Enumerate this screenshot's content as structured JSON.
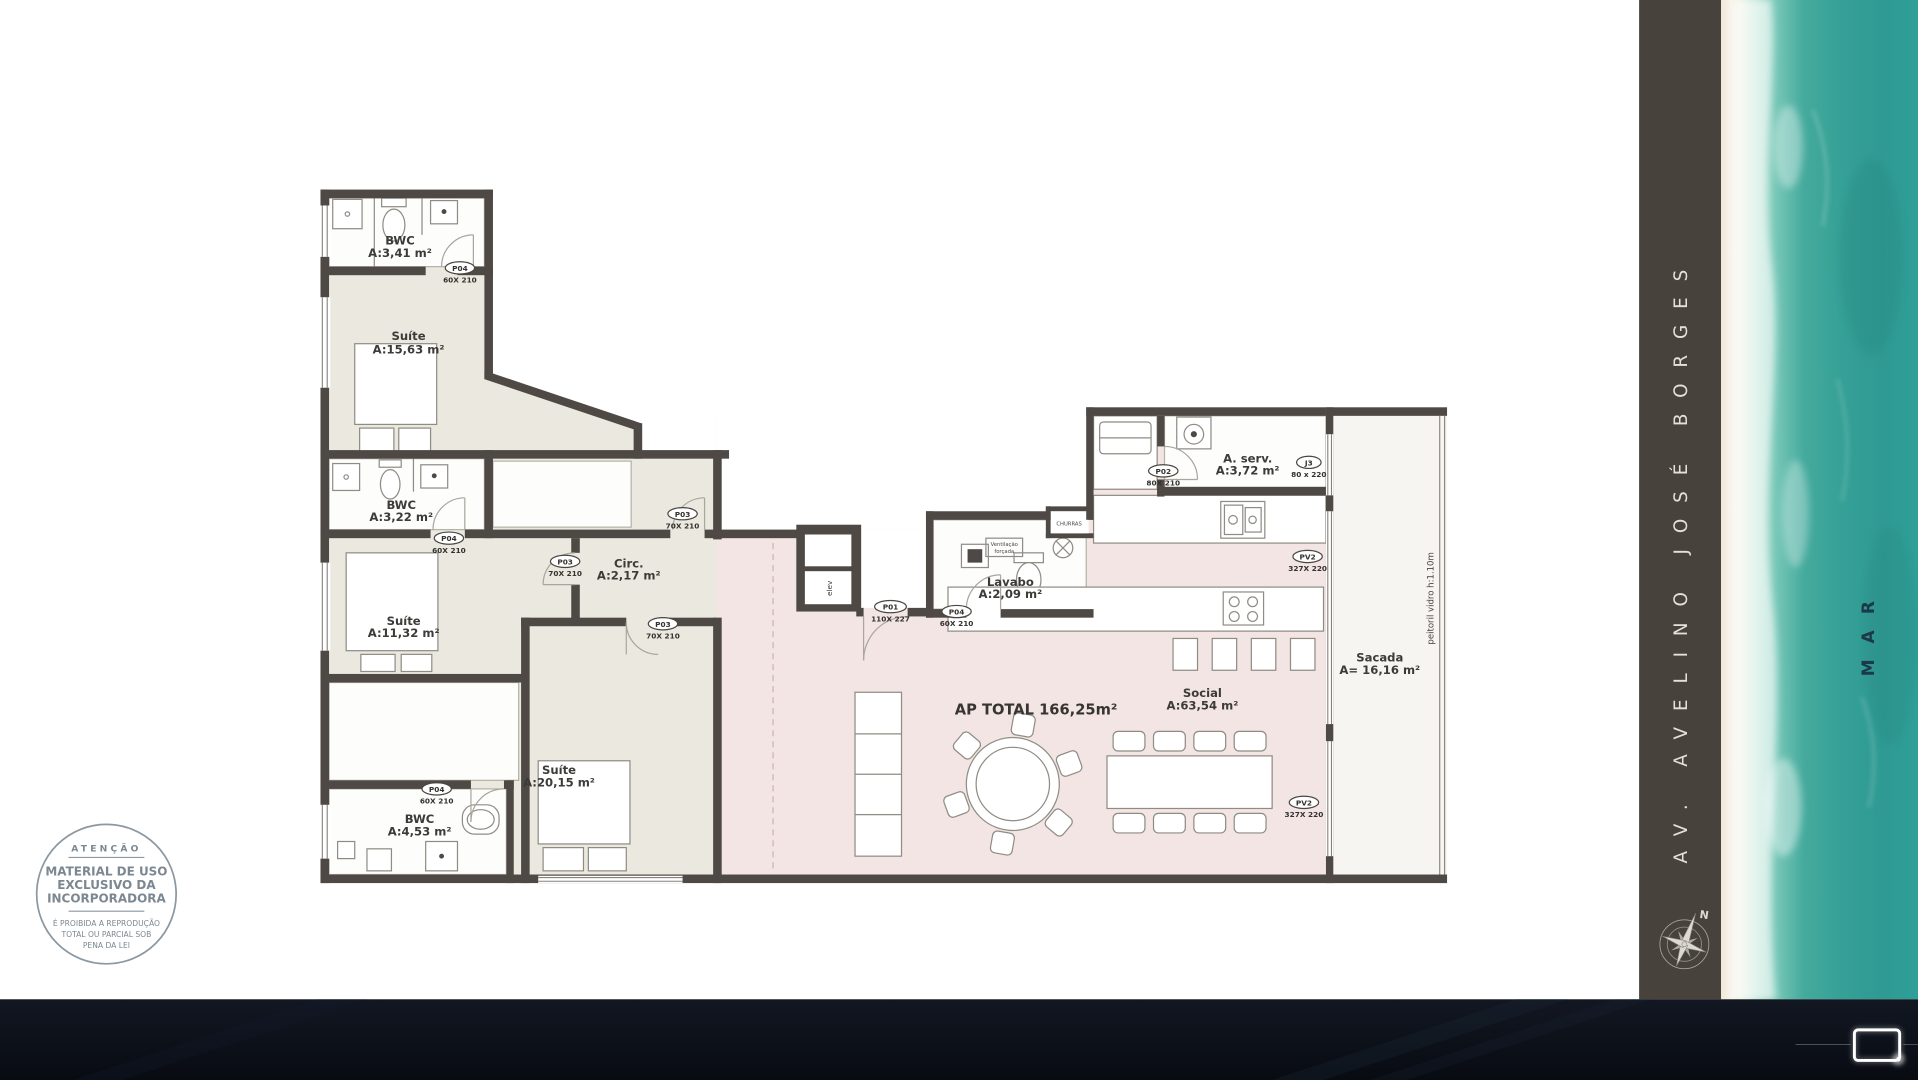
{
  "plan": {
    "rooms": [
      {
        "name": "BWC",
        "area": "A:3,41 m²"
      },
      {
        "name": "Suíte",
        "area": "A:15,63 m²"
      },
      {
        "name": "BWC",
        "area": "A:3,22 m²"
      },
      {
        "name": "Circ.",
        "area": "A:2,17 m²"
      },
      {
        "name": "Suíte",
        "area": "A:11,32 m²"
      },
      {
        "name": "Suíte",
        "area": "A:20,15 m²"
      },
      {
        "name": "BWC",
        "area": "A:4,53 m²"
      },
      {
        "name": "Lavabo",
        "area": "A:2,09 m²"
      },
      {
        "name": "A. serv.",
        "area": "A:3,72 m²"
      },
      {
        "name": "Social",
        "area": "A:63,54 m²"
      },
      {
        "name": "Sacada",
        "area": "A= 16,16 m²"
      }
    ],
    "doors": [
      {
        "code": "P04",
        "size": "60X 210"
      },
      {
        "code": "P04",
        "size": "60X 210"
      },
      {
        "code": "P03",
        "size": "70X 210"
      },
      {
        "code": "P03",
        "size": "70X 210"
      },
      {
        "code": "P03",
        "size": "70X 210"
      },
      {
        "code": "P04",
        "size": "60X 210"
      },
      {
        "code": "P01",
        "size": "110X 227"
      },
      {
        "code": "P04",
        "size": "60X 210"
      },
      {
        "code": "P02",
        "size": "80X 210"
      },
      {
        "code": "J3",
        "size": "80 x 220"
      },
      {
        "code": "PV2",
        "size": "327X 220"
      },
      {
        "code": "PV2",
        "size": "327X 220"
      }
    ],
    "ap_total": "AP TOTAL 166,25m²",
    "peitoril": "peitoril vidro h:1.10m",
    "churras": "CHURRAS",
    "vent_line1": "Ventilação",
    "vent_line2": "forçada",
    "elevator_hall": "H",
    "elevator_cab": "elev"
  },
  "stamp": {
    "title": "ATENÇÃO",
    "line1": "MATERIAL DE USO",
    "line2": "EXCLUSIVO DA",
    "line3": "INCORPORADORA",
    "note1": "É PROIBIDA A REPRODUÇÃO",
    "note2": "TOTAL OU PARCIAL SOB",
    "note3": "PENA DA LEI"
  },
  "sidebar": {
    "street": "AV. AVELINO JOSÉ BORGES",
    "compass_n": "N"
  },
  "ocean": {
    "label": "MAR"
  },
  "colors": {
    "wall": "#4e4944",
    "left_wing_floor": "#ebe9df",
    "social_floor": "#f3e5e3",
    "balcony_floor": "#f6f5f1",
    "panel": "#47423b",
    "sea_teal": "#36a198",
    "bottom_bar": "#0b0f18",
    "stamp_blue_gray": "#7b8791"
  }
}
